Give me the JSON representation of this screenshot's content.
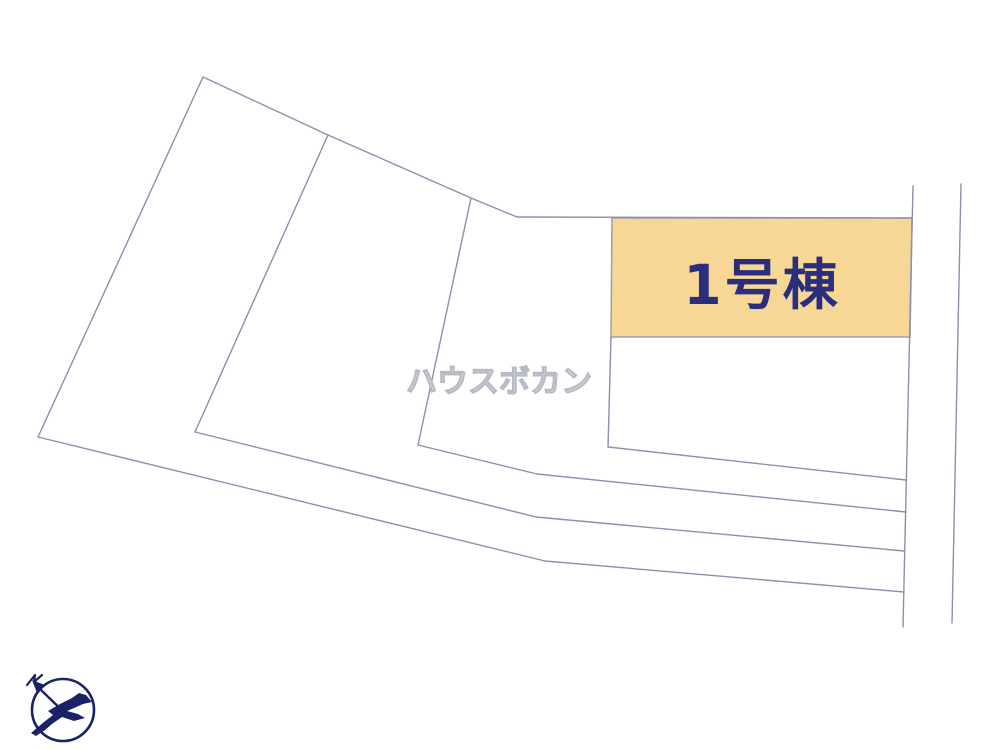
{
  "diagram": {
    "type": "real-estate-site-plan",
    "watermark_text": "ハウスボカン",
    "highlight_parcel": {
      "label": "1号棟",
      "highlighted": true
    },
    "compass": {
      "icon": "bird-compass-icon",
      "north_mark": "N"
    }
  },
  "colors": {
    "background": "#ffffff",
    "line": "#8d8fae",
    "line_gray": "#a2a2aa",
    "parcel_fill": "#f6d795",
    "label_navy": "#2b2e7d",
    "compass_navy": "#1b2166",
    "watermark_stroke": "#b8b9c6"
  }
}
